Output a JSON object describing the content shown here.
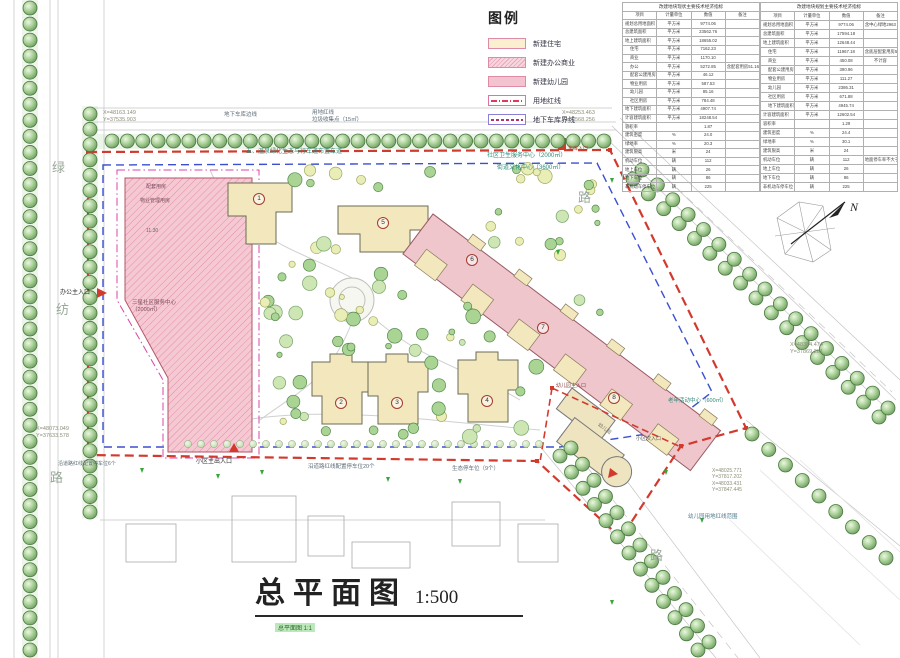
{
  "legend": {
    "title": "图例",
    "items": [
      {
        "label": "新建住宅"
      },
      {
        "label": "新建办公商业"
      },
      {
        "label": "新建幼儿园"
      },
      {
        "label": "用地红线"
      },
      {
        "label": "地下车库界线"
      }
    ]
  },
  "table": {
    "left": {
      "title": "改建地块现状主要技术经济指标",
      "headers": [
        "项目",
        "计量单位",
        "数值",
        "备注"
      ],
      "rows": [
        [
          "规划总用地面积",
          "平方米",
          "9774.06",
          ""
        ],
        [
          "总建筑面积",
          "平方米",
          "23562.76",
          ""
        ],
        [
          "地上建筑面积",
          "平方米",
          "18655.02",
          ""
        ],
        [
          "住宅",
          "平方米",
          "7162.23",
          ""
        ],
        [
          "商业",
          "平方米",
          "1170.10",
          ""
        ],
        [
          "办公",
          "平方米",
          "5272.85",
          "含配套用房51.16"
        ],
        [
          "配套公建用房",
          "平方米",
          "46.12",
          ""
        ],
        [
          "物业用房",
          "平方米",
          "587.53",
          ""
        ],
        [
          "幼儿园",
          "平方米",
          "85.16",
          ""
        ],
        [
          "社区用房",
          "平方米",
          "784.48",
          ""
        ],
        [
          "地下建筑面积",
          "平方米",
          "4907.74",
          ""
        ],
        [
          "计容建筑面积",
          "平方米",
          "18248.54",
          ""
        ],
        [
          "容积率",
          "",
          "1.87",
          ""
        ],
        [
          "建筑密度",
          "%",
          "24.0",
          ""
        ],
        [
          "绿地率",
          "%",
          "20.3",
          ""
        ],
        [
          "建筑限高",
          "米",
          "24",
          ""
        ],
        [
          "机动车位",
          "辆",
          "112",
          ""
        ],
        [
          "地上车位",
          "辆",
          "26",
          ""
        ],
        [
          "地下车位",
          "辆",
          "86",
          ""
        ],
        [
          "非机动车停车位",
          "辆",
          "225",
          ""
        ]
      ]
    },
    "right": {
      "title": "改建地块规划主要技术经济指标",
      "headers": [
        "项目",
        "计量单位",
        "数值",
        "备注"
      ],
      "rows": [
        [
          "规划总用地面积",
          "平方米",
          "9774.06",
          "含中心绿地2963"
        ],
        [
          "总建筑面积",
          "平方米",
          "17594.18",
          ""
        ],
        [
          "地上建筑面积",
          "平方米",
          "12648.44",
          ""
        ],
        [
          "住宅",
          "平方米",
          "11967.18",
          "含底层配套用房56.35"
        ],
        [
          "商业",
          "平方米",
          "450.08",
          "不计容"
        ],
        [
          "配套公建用房",
          "平方米",
          "390.96",
          ""
        ],
        [
          "物业用房",
          "平方米",
          "111.27",
          ""
        ],
        [
          "幼儿园",
          "平方米",
          "2386.31",
          ""
        ],
        [
          "社区用房",
          "平方米",
          "671.88",
          ""
        ],
        [
          "地下建筑面积",
          "平方米",
          "4945.74",
          ""
        ],
        [
          "计容建筑面积",
          "平方米",
          "12602.54",
          ""
        ],
        [
          "容积率",
          "",
          "1.29",
          ""
        ],
        [
          "建筑密度",
          "%",
          "24.4",
          ""
        ],
        [
          "绿地率",
          "%",
          "30.1",
          ""
        ],
        [
          "建筑限高",
          "米",
          "24",
          ""
        ],
        [
          "机动车位",
          "辆",
          "112",
          "地面停车率不大于10%"
        ],
        [
          "地上车位",
          "辆",
          "26",
          ""
        ],
        [
          "地下车位",
          "辆",
          "86",
          ""
        ],
        [
          "非机动车停车位",
          "辆",
          "225",
          ""
        ]
      ]
    }
  },
  "plan": {
    "labels": {
      "coord_tl": "X=48163.149\nY=37535.903",
      "garage_edge": "地下车库边线",
      "redline_lbl": "用地红线\n垃圾收集点（15㎡）",
      "coord_tr": "X=48253.463\nY=37568.256",
      "note5": "五、温泉绿化生态与行车道布置车道",
      "svc": "社区卫生服务中心（2000㎡）",
      "culture": "街道文化中心（3600㎡）",
      "elderly": "老年活动中心（600㎡）",
      "coord_r": "X=48384.474\nY=37869.261",
      "coord_br": "X=48025.771\nY=37817.202\nX=48033.431\nY=37847.445",
      "kg_line": "幼儿园用地红线范围",
      "kg_entry": "幼儿园主入口",
      "side_entry": "小区次入口",
      "garage_entry": "车库入口",
      "office_entry": "办公主入口",
      "coord_bl": "X=48073.049\nY=37633.578",
      "main_entry": "小区主出入口",
      "parking6": "沿道路红线配置停车位6个",
      "parking20": "沿道路红线配置停车位20个",
      "eco_parking": "生态停车位（9个）",
      "office1": "配套用房",
      "office2": "物业管理用房",
      "office3": "三星社区服务中心\n（2000㎡）",
      "office_num": "11.30",
      "kg_name": "幼儿园",
      "road_left1": "绿",
      "road_left2": "纺",
      "road_left3": "路",
      "road_ne": "路",
      "road_se": "路",
      "north": "N"
    },
    "buildings": {
      "b1": "1",
      "b2": "2",
      "b3": "3",
      "b4": "4",
      "b5": "5",
      "b6": "6",
      "b7": "7",
      "b8": "8"
    }
  },
  "title": {
    "main": "总平面图",
    "scale": "1:500",
    "sub": "总平面图 1:1"
  }
}
